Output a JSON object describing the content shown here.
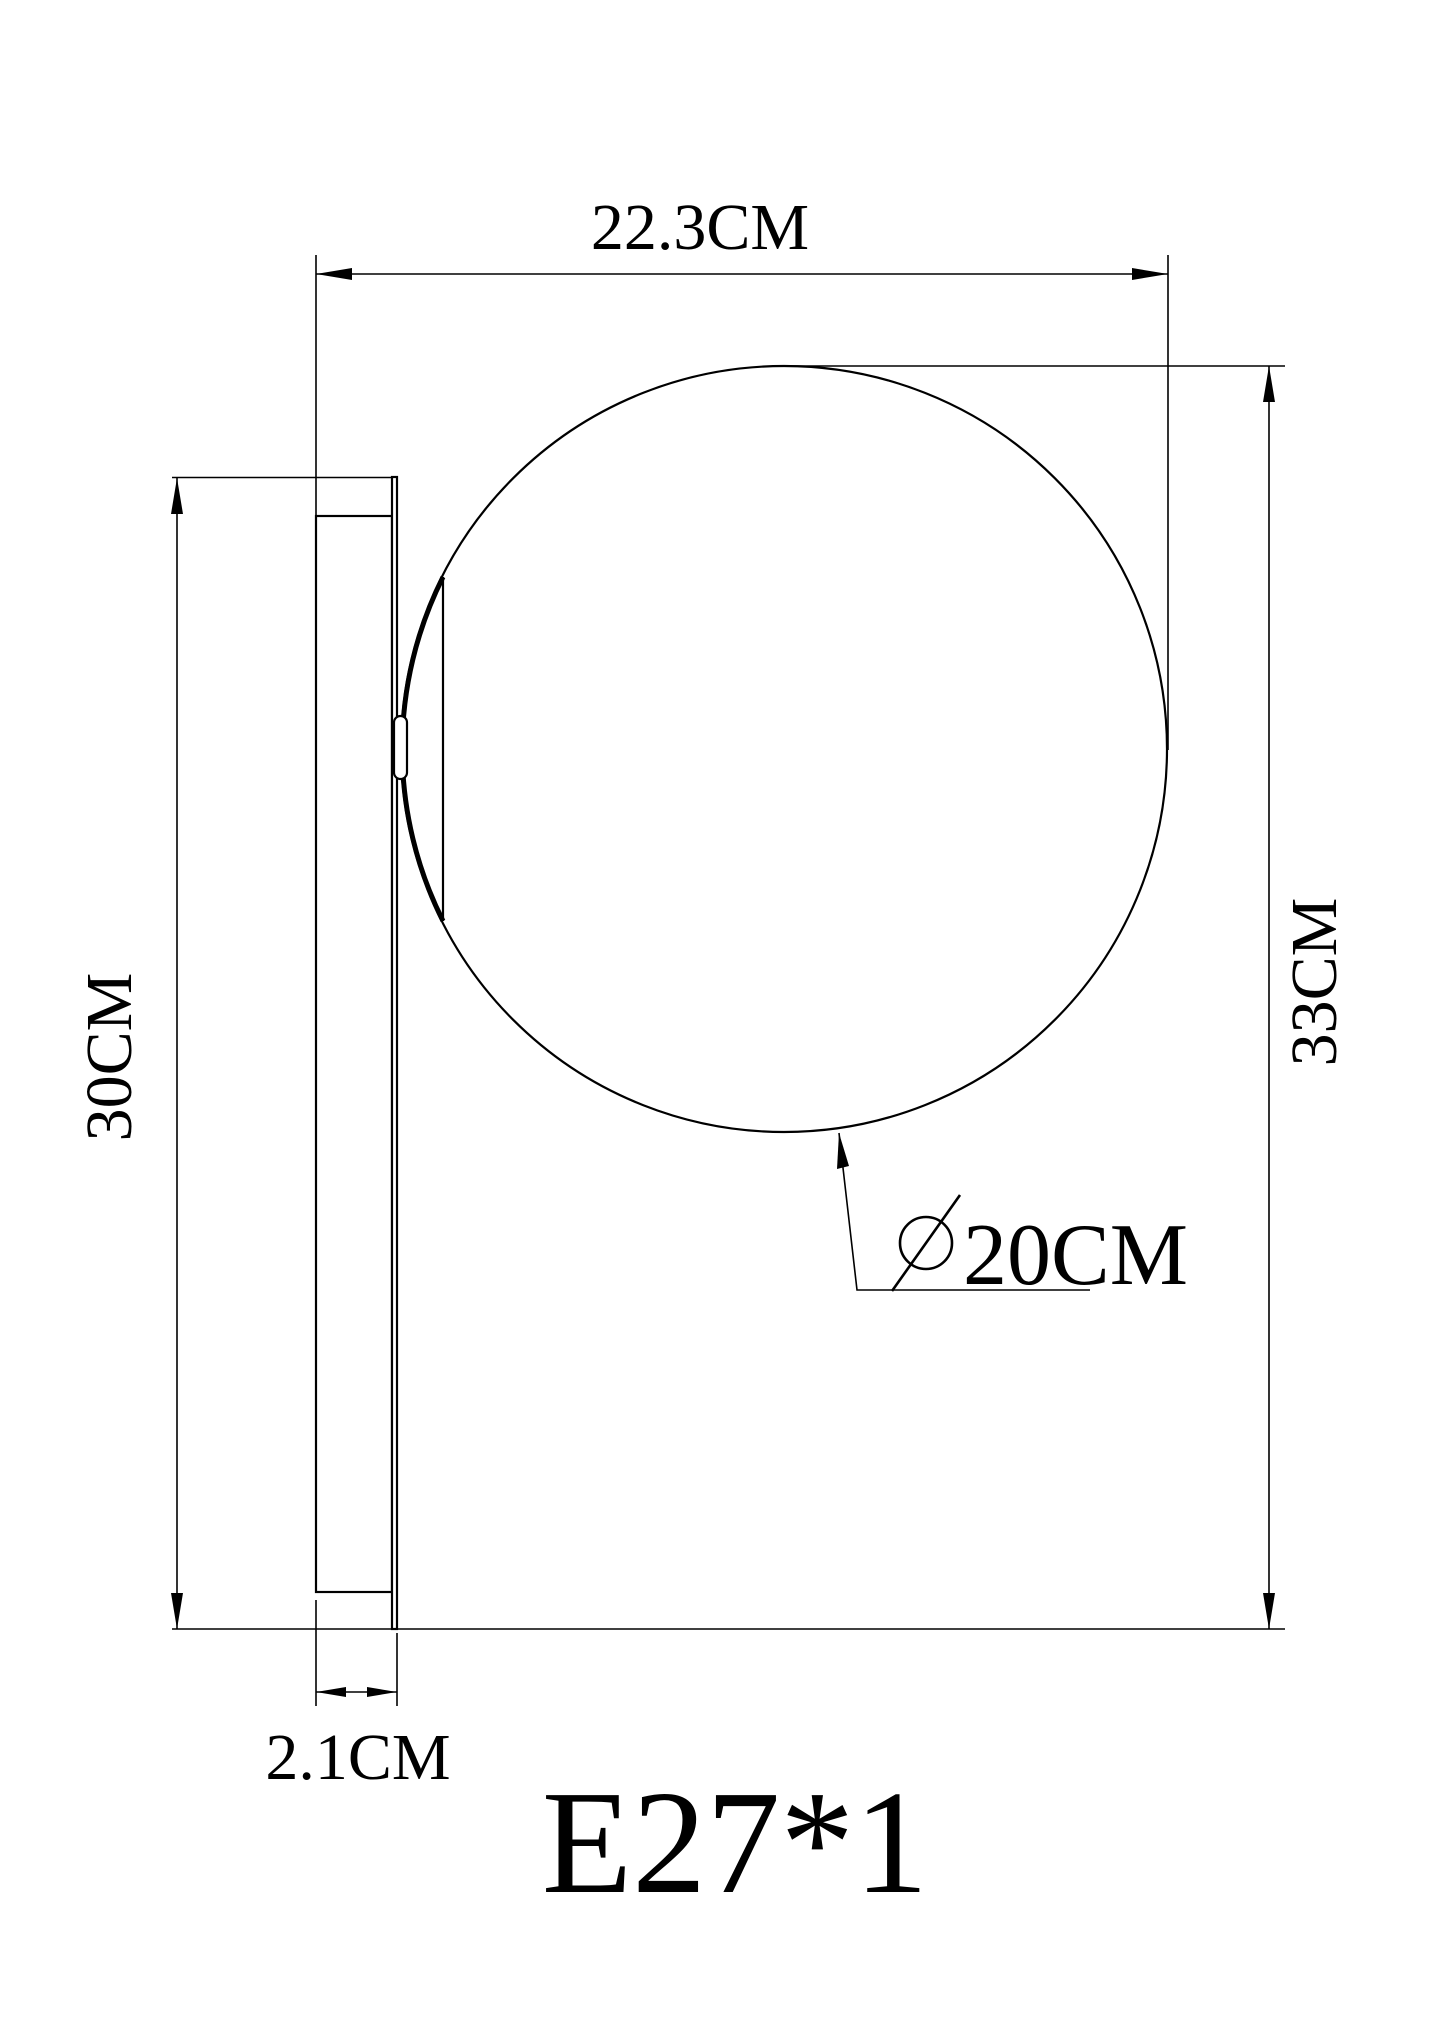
{
  "drawing": {
    "type": "technical dimension drawing of globe wall lamp, side view",
    "labels": {
      "width": "22.3CM",
      "total_height": "33CM",
      "plate_height": "30CM",
      "plate_depth": "2.1CM",
      "diameter_symbol": "diameter-sign",
      "globe_diameter": "20CM",
      "socket": "E27*1"
    },
    "colors": {
      "line": "#000000",
      "background": "#ffffff"
    }
  }
}
